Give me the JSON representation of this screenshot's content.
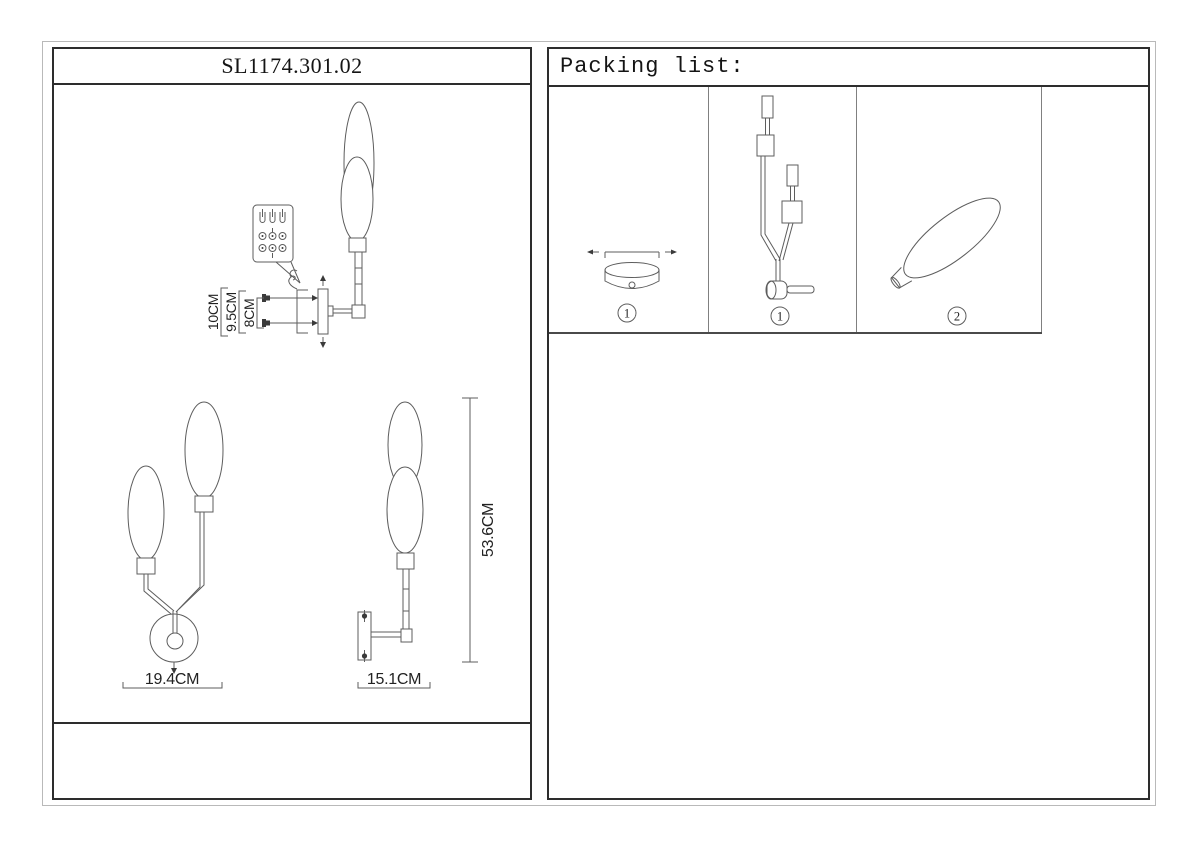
{
  "sheet": {
    "model_number": "SL1174.301.02",
    "packing_header": "Packing list:"
  },
  "dimensions": {
    "mount_height": "10CM",
    "mount_screw_span": "9.5CM",
    "mount_screw_gap": "8CM",
    "front_width": "19.4CM",
    "side_depth": "15.1CM",
    "total_height": "53.6CM"
  },
  "packing_items": [
    {
      "part": "wall-mount-canopy",
      "qty": "1"
    },
    {
      "part": "lamp-frame-arms",
      "qty": "1"
    },
    {
      "part": "glass-shade",
      "qty": "2"
    }
  ],
  "colors": {
    "panel_border": "#2d2d2d",
    "grid_line": "#808080",
    "drawing_line": "#5d5d5d",
    "sheet_outline": "#b9b9b9"
  }
}
